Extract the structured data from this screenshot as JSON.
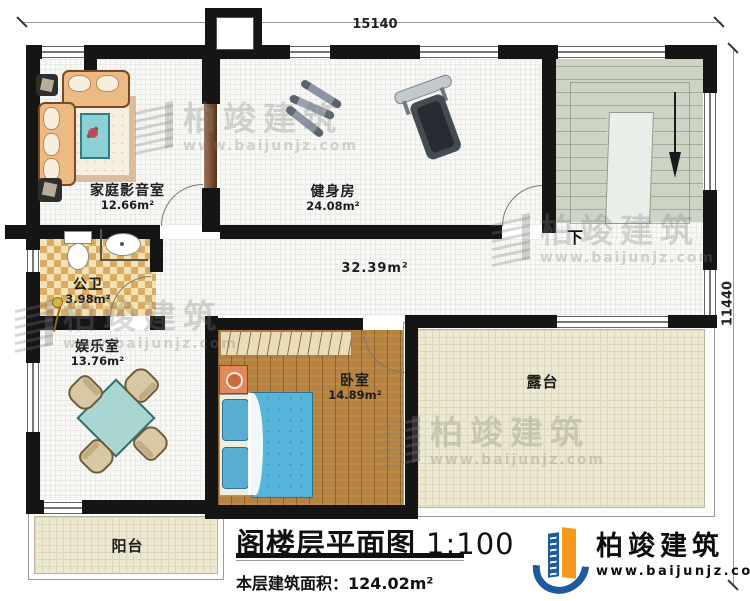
{
  "dimensions": {
    "top": "15140",
    "right": "11440"
  },
  "rooms": {
    "home_theater": {
      "name": "家庭影音室",
      "area": "12.66m²"
    },
    "gym": {
      "name": "健身房",
      "area": "24.08m²"
    },
    "bathroom": {
      "name": "公卫",
      "area": "3.98m²"
    },
    "entertainment": {
      "name": "娱乐室",
      "area": "13.76m²"
    },
    "bedroom": {
      "name": "卧室",
      "area": "14.89m²"
    },
    "hallway": {
      "area": "32.39m²"
    },
    "terrace": {
      "name": "露台"
    },
    "balcony": {
      "name": "阳台"
    },
    "stairs": {
      "direction_label": "下"
    }
  },
  "title_block": {
    "title": "阁楼层平面图",
    "scale": "1:100",
    "floor_area_label": "本层建筑面积：",
    "floor_area_value": "124.02m²"
  },
  "brand": {
    "name": "柏竣建筑",
    "website": "www.baijunjz.com"
  },
  "watermark": {
    "name": "柏竣建筑",
    "website": "www.baijunjz.com"
  },
  "colors": {
    "wall": "#151515",
    "wood_floor": "#b5823f",
    "stair_floor": "#ccd5c5",
    "terrace_floor": "#ece8d1",
    "bathroom_tile": "#dcab62",
    "bed_blue": "#57b4da",
    "logo_blue": "#1d5a9e",
    "logo_orange": "#f59a1e"
  }
}
